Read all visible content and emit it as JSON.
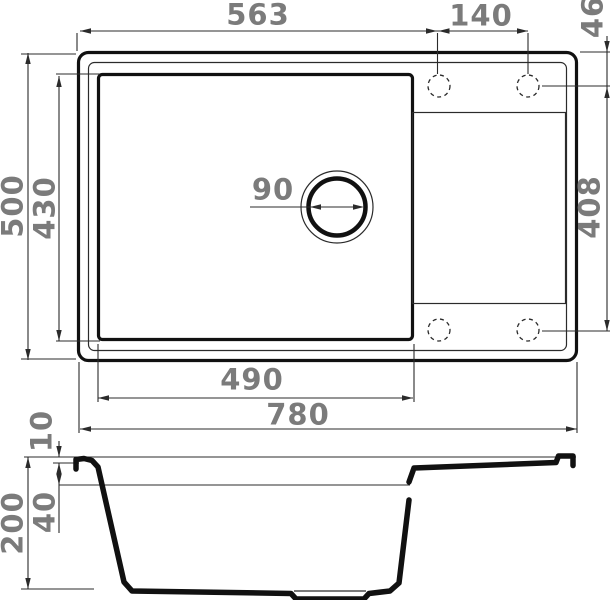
{
  "drawing": {
    "subject": "sink-technical-drawing",
    "views": [
      "top-view",
      "cross-section-view"
    ]
  },
  "dimensions": {
    "top_view": {
      "left_section_width": "563",
      "faucet_hole_spacing": "140",
      "faucet_hole_back_offset": "46",
      "overall_depth": "500",
      "bowl_depth": "430",
      "drain_diameter": "90",
      "faucet_hole_row_span": "408",
      "bowl_width": "490",
      "overall_width": "780"
    },
    "section_view": {
      "rim_lip_height": "10",
      "ledge_depth": "40",
      "overall_height": "200"
    }
  },
  "colors": {
    "outline": "#111111",
    "dim_line": "#2b2b2b",
    "dim_text": "#7b7b7b",
    "background": "#ffffff"
  }
}
